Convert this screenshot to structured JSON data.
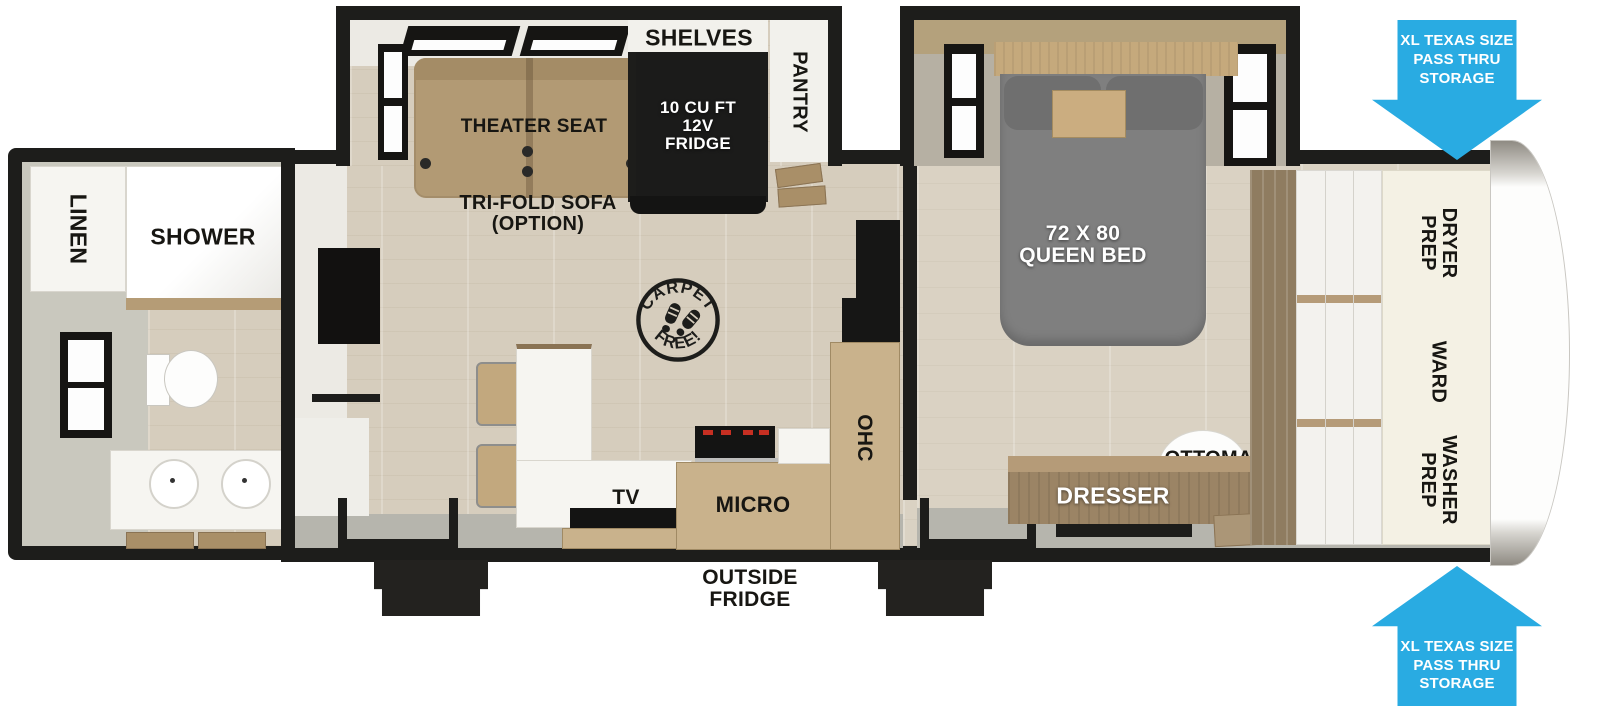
{
  "colors": {
    "accent_blue": "#29ABE2",
    "wall_black": "#1d1d1b",
    "wood_floor": "#d6cdbd",
    "bed_gray": "#7f7f7f",
    "cream_panel": "#f4f1e4"
  },
  "bathroom": {
    "linen_label": "LINEN",
    "shower_label": "SHOWER"
  },
  "living_area": {
    "shelves_label": "SHELVES",
    "pantry_label": "PANTRY",
    "fridge_label_lines": [
      "10 CU FT",
      "12V",
      "FRIDGE"
    ],
    "theater_seat_label": "THEATER SEAT",
    "trifold_sofa_lines": [
      "TRI-FOLD SOFA",
      "(OPTION)"
    ],
    "carpet_stamp": {
      "top": "CARPET",
      "bottom": "FREE!"
    },
    "tv_label": "TV",
    "micro_label": "MICRO",
    "ohc_label": "OHC",
    "outside_fridge_lines": [
      "OUTSIDE",
      "FRIDGE"
    ]
  },
  "bedroom": {
    "bed_label_lines": [
      "72 X 80",
      "QUEEN BED"
    ],
    "dresser_label": "DRESSER",
    "ottoman_label": "OTTOMAN",
    "wardrobe_labels": {
      "dryer_lines": [
        "DRYER",
        "PREP"
      ],
      "ward": "WARD",
      "washer_lines": [
        "WASHER",
        "PREP"
      ]
    }
  },
  "storage_arrows": {
    "top_lines": [
      "XL TEXAS SIZE",
      "PASS THRU",
      "STORAGE"
    ],
    "bottom_lines": [
      "XL TEXAS SIZE",
      "PASS THRU",
      "STORAGE"
    ]
  }
}
